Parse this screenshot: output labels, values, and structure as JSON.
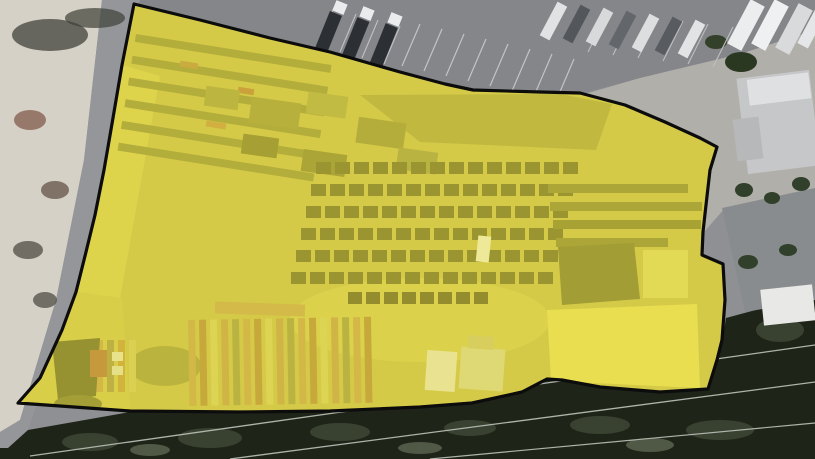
{
  "map": {
    "type": "satellite-imagery",
    "description": "Aerial satellite view of an industrial lumber/storage yard parcel highlighted with a yellow polygon outline",
    "overlay": {
      "name": "parcel-highlight",
      "fill": "#e8de3a",
      "fill_opacity": 0.44,
      "stroke": "#0c0c0c",
      "stroke_width": 3.2,
      "points": "134,4 200,20 270,38 330,52 400,72 445,84 473,90 540,92 580,93 625,105 665,122 700,138 717,147 710,170 706,205 703,232 702,255 723,264 725,300 722,340 717,360 708,389 660,392 600,387 562,380 547,379 522,392 472,403 420,407 330,411 240,412 130,411 60,406 18,403 40,378 62,330 76,292 86,252 95,215 104,170 113,118 122,65"
    },
    "features": [
      {
        "kind": "rect",
        "name": "asphalt-base",
        "x": 0,
        "y": 0,
        "w": 815,
        "h": 459,
        "fill": "#8e9093"
      },
      {
        "kind": "polygon",
        "name": "parking-lot",
        "points": "0,0 815,0 815,30 740,54 640,78 580,94 470,91 400,72 330,52 134,4",
        "fill": "#84868a"
      },
      {
        "kind": "polygon",
        "name": "concrete-apron",
        "points": "585,94 640,78 740,54 815,30 815,200 725,208 704,232 706,178 717,147 665,122 622,104",
        "fill": "#b1afaa"
      },
      {
        "kind": "polygon",
        "name": "debris-lot",
        "points": "0,0 102,0 84,160 56,300 20,420 0,432",
        "fill": "#d6d1c6"
      },
      {
        "kind": "polygon",
        "name": "road",
        "points": "102,0 140,0 122,65 104,170 86,252 62,330 28,430 8,448 0,448 0,432 20,420 56,300 84,160",
        "fill": "#95969a"
      },
      {
        "kind": "ellipse",
        "name": "debris-shadow",
        "cx": 50,
        "cy": 35,
        "rx": 38,
        "ry": 16,
        "fill": "#4b4b44",
        "opacity": 0.8
      },
      {
        "kind": "ellipse",
        "name": "debris-shadow",
        "cx": 95,
        "cy": 18,
        "rx": 30,
        "ry": 10,
        "fill": "#3f4038",
        "opacity": 0.7
      },
      {
        "kind": "ellipse",
        "name": "debris-pile",
        "cx": 30,
        "cy": 120,
        "rx": 16,
        "ry": 10,
        "fill": "#8c6a5a",
        "opacity": 0.85
      },
      {
        "kind": "ellipse",
        "name": "debris-pile",
        "cx": 55,
        "cy": 190,
        "rx": 14,
        "ry": 9,
        "fill": "#6b5a50",
        "opacity": 0.8
      },
      {
        "kind": "ellipse",
        "name": "debris-pile",
        "cx": 28,
        "cy": 250,
        "rx": 15,
        "ry": 9,
        "fill": "#57544c",
        "opacity": 0.8
      },
      {
        "kind": "ellipse",
        "name": "debris-pile",
        "cx": 45,
        "cy": 300,
        "rx": 12,
        "ry": 8,
        "fill": "#4e4c44",
        "opacity": 0.75
      },
      {
        "kind": "polygon",
        "name": "tree-canopy",
        "points": "0,448 8,448 28,430 130,412 240,413 330,412 420,408 472,403 522,392 547,379 562,380 600,387 660,392 708,389 717,360 724,330 726,318 815,294 815,459 0,459",
        "fill": "#1f2419"
      },
      {
        "kind": "ellipse",
        "name": "tree-blob",
        "cx": 90,
        "cy": 442,
        "rx": 28,
        "ry": 9,
        "fill": "#3c4634",
        "opacity": 0.9
      },
      {
        "kind": "ellipse",
        "name": "tree-blob",
        "cx": 210,
        "cy": 438,
        "rx": 32,
        "ry": 10,
        "fill": "#3c4634",
        "opacity": 0.9
      },
      {
        "kind": "ellipse",
        "name": "tree-blob",
        "cx": 340,
        "cy": 432,
        "rx": 30,
        "ry": 9,
        "fill": "#3c4634",
        "opacity": 0.9
      },
      {
        "kind": "ellipse",
        "name": "tree-blob",
        "cx": 470,
        "cy": 428,
        "rx": 26,
        "ry": 8,
        "fill": "#3c4634",
        "opacity": 0.9
      },
      {
        "kind": "ellipse",
        "name": "tree-blob",
        "cx": 600,
        "cy": 425,
        "rx": 30,
        "ry": 9,
        "fill": "#3c4634",
        "opacity": 0.9
      },
      {
        "kind": "ellipse",
        "name": "tree-blob",
        "cx": 720,
        "cy": 430,
        "rx": 34,
        "ry": 10,
        "fill": "#3c4634",
        "opacity": 0.9
      },
      {
        "kind": "ellipse",
        "name": "tree-blob",
        "cx": 780,
        "cy": 330,
        "rx": 24,
        "ry": 12,
        "fill": "#3c4634",
        "opacity": 0.9
      },
      {
        "kind": "ellipse",
        "name": "tree-blob",
        "cx": 150,
        "cy": 450,
        "rx": 20,
        "ry": 6,
        "fill": "#5d6650",
        "opacity": 0.8
      },
      {
        "kind": "ellipse",
        "name": "tree-blob",
        "cx": 420,
        "cy": 448,
        "rx": 22,
        "ry": 6,
        "fill": "#5d6650",
        "opacity": 0.8
      },
      {
        "kind": "ellipse",
        "name": "tree-blob",
        "cx": 650,
        "cy": 445,
        "rx": 24,
        "ry": 7,
        "fill": "#5d6650",
        "opacity": 0.8
      },
      {
        "kind": "line",
        "name": "power-line",
        "x1": 30,
        "y1": 456,
        "x2": 815,
        "y2": 345,
        "stroke": "#aeb4aa",
        "sw": 1.3
      },
      {
        "kind": "line",
        "name": "power-line",
        "x1": 230,
        "y1": 459,
        "x2": 815,
        "y2": 382,
        "stroke": "#aeb4aa",
        "sw": 1.3
      },
      {
        "kind": "line",
        "name": "power-line",
        "x1": 430,
        "y1": 459,
        "x2": 815,
        "y2": 423,
        "stroke": "#aeb4aa",
        "sw": 1.2
      },
      {
        "kind": "rect",
        "name": "building-roof-light",
        "x": 742,
        "y": 74,
        "w": 73,
        "h": 96,
        "fill": "#c6c7c9",
        "rot": -7
      },
      {
        "kind": "rect",
        "name": "building-roof-white",
        "x": 748,
        "y": 76,
        "w": 62,
        "h": 26,
        "fill": "#dfe0e2",
        "rot": -7
      },
      {
        "kind": "rect",
        "name": "building-annex",
        "x": 735,
        "y": 118,
        "w": 26,
        "h": 42,
        "fill": "#b7b8ba",
        "rot": -7
      },
      {
        "kind": "polygon",
        "name": "building-dark-block",
        "points": "722,208 815,188 815,300 745,312",
        "fill": "#898c8e"
      },
      {
        "kind": "ellipse",
        "name": "shrub",
        "cx": 744,
        "cy": 190,
        "rx": 9,
        "ry": 7,
        "fill": "#31402a"
      },
      {
        "kind": "ellipse",
        "name": "shrub",
        "cx": 772,
        "cy": 198,
        "rx": 8,
        "ry": 6,
        "fill": "#31402a"
      },
      {
        "kind": "ellipse",
        "name": "shrub",
        "cx": 801,
        "cy": 184,
        "rx": 9,
        "ry": 7,
        "fill": "#31402a"
      },
      {
        "kind": "ellipse",
        "name": "shrub",
        "cx": 748,
        "cy": 262,
        "rx": 10,
        "ry": 7,
        "fill": "#31402a"
      },
      {
        "kind": "ellipse",
        "name": "shrub",
        "cx": 788,
        "cy": 250,
        "rx": 9,
        "ry": 6,
        "fill": "#31402a"
      },
      {
        "kind": "rect",
        "name": "building-white-small",
        "x": 762,
        "y": 287,
        "w": 52,
        "h": 36,
        "fill": "#e8e8e6",
        "rot": -6
      },
      {
        "kind": "ellipse",
        "name": "palm-tree",
        "cx": 741,
        "cy": 62,
        "rx": 16,
        "ry": 10,
        "fill": "#2b3821"
      },
      {
        "kind": "ellipse",
        "name": "palm-tree",
        "cx": 716,
        "cy": 42,
        "rx": 11,
        "ry": 7,
        "fill": "#33402a"
      },
      {
        "kind": "lineset",
        "name": "parking-stripes",
        "x": 402,
        "y": 66,
        "dx": 18,
        "dy": -42,
        "n": 8,
        "sx": 22,
        "sy": 5,
        "stroke": "#c2c4c6",
        "sw": 1.2
      },
      {
        "kind": "lineset",
        "name": "parking-stripes",
        "x": 318,
        "y": 46,
        "dx": 16,
        "dy": -38,
        "n": 4,
        "sx": 22,
        "sy": 6,
        "stroke": "#bfc1c3",
        "sw": 1.1
      },
      {
        "kind": "lineset",
        "name": "parking-stripes",
        "x": 588,
        "y": 52,
        "dx": 20,
        "dy": -40,
        "n": 6,
        "sx": 25,
        "sy": 3,
        "stroke": "#bcbec0",
        "sw": 1.1
      },
      {
        "kind": "rect",
        "name": "semi-truck-body",
        "x": 322,
        "y": 12,
        "w": 13,
        "h": 40,
        "fill": "#2c3035",
        "rot": 22
      },
      {
        "kind": "rect",
        "name": "semi-truck-body",
        "x": 349,
        "y": 18,
        "w": 13,
        "h": 42,
        "fill": "#2c3035",
        "rot": 22
      },
      {
        "kind": "rect",
        "name": "semi-truck-body",
        "x": 377,
        "y": 24,
        "w": 13,
        "h": 44,
        "fill": "#2c3035",
        "rot": 22
      },
      {
        "kind": "rect",
        "name": "semi-truck-cab",
        "x": 334,
        "y": 2,
        "w": 12,
        "h": 11,
        "fill": "#e9ebed",
        "rot": 22
      },
      {
        "kind": "rect",
        "name": "semi-truck-cab",
        "x": 361,
        "y": 8,
        "w": 12,
        "h": 11,
        "fill": "#e9ebed",
        "rot": 22
      },
      {
        "kind": "rect",
        "name": "semi-truck-cab",
        "x": 389,
        "y": 14,
        "w": 12,
        "h": 11,
        "fill": "#e9ebed",
        "rot": 22
      },
      {
        "kind": "rect",
        "name": "parked-trailer",
        "x": 548,
        "y": 2,
        "w": 11,
        "h": 38,
        "fill": "#e0e2e4",
        "rot": 28
      },
      {
        "kind": "rect",
        "name": "parked-trailer",
        "x": 571,
        "y": 5,
        "w": 11,
        "h": 38,
        "fill": "#53575b",
        "rot": 28
      },
      {
        "kind": "rect",
        "name": "parked-trailer",
        "x": 594,
        "y": 8,
        "w": 11,
        "h": 38,
        "fill": "#d7d9db",
        "rot": 28
      },
      {
        "kind": "rect",
        "name": "parked-trailer",
        "x": 617,
        "y": 11,
        "w": 11,
        "h": 38,
        "fill": "#63676b",
        "rot": 28
      },
      {
        "kind": "rect",
        "name": "parked-trailer",
        "x": 640,
        "y": 14,
        "w": 11,
        "h": 38,
        "fill": "#dcdee0",
        "rot": 28
      },
      {
        "kind": "rect",
        "name": "parked-trailer",
        "x": 663,
        "y": 17,
        "w": 11,
        "h": 38,
        "fill": "#585c60",
        "rot": 28
      },
      {
        "kind": "rect",
        "name": "parked-trailer",
        "x": 686,
        "y": 20,
        "w": 11,
        "h": 38,
        "fill": "#e2e3e5",
        "rot": 28
      },
      {
        "kind": "rect",
        "name": "parked-trailer",
        "x": 738,
        "y": 0,
        "w": 16,
        "h": 50,
        "fill": "#ebedef",
        "rot": 28
      },
      {
        "kind": "rect",
        "name": "parked-trailer",
        "x": 762,
        "y": 0,
        "w": 16,
        "h": 50,
        "fill": "#eff0f2",
        "rot": 28
      },
      {
        "kind": "rect",
        "name": "parked-trailer",
        "x": 786,
        "y": 4,
        "w": 16,
        "h": 50,
        "fill": "#d8dadc",
        "rot": 28
      },
      {
        "kind": "rect",
        "name": "parked-trailer",
        "x": 806,
        "y": 8,
        "w": 12,
        "h": 40,
        "fill": "#e5e6e8",
        "rot": 28
      },
      {
        "kind": "rect",
        "name": "yard-ground",
        "x": 0,
        "y": 0,
        "w": 815,
        "h": 459,
        "fill": "#c6ba52",
        "clip": true
      },
      {
        "kind": "polygon",
        "name": "yard-bright-left",
        "points": "122,65 160,76 120,298 76,292",
        "fill": "#d6cb5c",
        "clip": true
      },
      {
        "kind": "polygon",
        "name": "yard-bright-sw",
        "points": "76,292 122,298 130,410 18,403 40,378 62,330",
        "fill": "#ccc052",
        "clip": true
      },
      {
        "kind": "ellipse",
        "name": "yard-open-ground",
        "cx": 420,
        "cy": 320,
        "rx": 130,
        "ry": 42,
        "fill": "#d2c75a",
        "clip": true
      },
      {
        "kind": "polygon",
        "name": "yard-bright-se",
        "points": "547,310 697,304 700,388 551,381",
        "fill": "#e8de62",
        "clip": true
      },
      {
        "kind": "polygon",
        "name": "yard-dense-storage",
        "points": "360,95 560,94 612,104 596,150 420,142",
        "fill": "#9d9745",
        "opacity": 0.9,
        "clip": true
      },
      {
        "kind": "stripes",
        "name": "storage-racks-nw",
        "x": 136,
        "y": 34,
        "w": 198,
        "h": 8,
        "n": 6,
        "step": 22,
        "dir": "h",
        "colors": [
          "#8a873d"
        ],
        "rot": 9,
        "clip": true
      },
      {
        "kind": "rect",
        "name": "rack-lumber-accent",
        "x": 180,
        "y": 62,
        "w": 18,
        "h": 6,
        "fill": "#b08246",
        "rot": 9,
        "clip": true
      },
      {
        "kind": "rect",
        "name": "rack-lumber-accent",
        "x": 238,
        "y": 88,
        "w": 16,
        "h": 6,
        "fill": "#b5713d",
        "rot": 9,
        "clip": true
      },
      {
        "kind": "rect",
        "name": "rack-lumber-accent",
        "x": 206,
        "y": 122,
        "w": 20,
        "h": 6,
        "fill": "#bf8a47",
        "rot": 9,
        "clip": true
      },
      {
        "kind": "rect",
        "name": "yard-structure",
        "x": 205,
        "y": 88,
        "w": 34,
        "h": 20,
        "fill": "#9a9545",
        "rot": 8,
        "clip": true
      },
      {
        "kind": "rect",
        "name": "yard-structure",
        "x": 250,
        "y": 100,
        "w": 50,
        "h": 26,
        "fill": "#908b40",
        "rot": 8,
        "clip": true
      },
      {
        "kind": "rect",
        "name": "yard-structure",
        "x": 307,
        "y": 94,
        "w": 40,
        "h": 22,
        "fill": "#a39d4b",
        "rot": 8,
        "clip": true
      },
      {
        "kind": "rect",
        "name": "yard-structure",
        "x": 357,
        "y": 120,
        "w": 48,
        "h": 26,
        "fill": "#8b863d",
        "rot": 8,
        "clip": true
      },
      {
        "kind": "rect",
        "name": "yard-structure",
        "x": 242,
        "y": 136,
        "w": 36,
        "h": 20,
        "fill": "#706d31",
        "rot": 8,
        "clip": true
      },
      {
        "kind": "rect",
        "name": "yard-structure",
        "x": 302,
        "y": 152,
        "w": 44,
        "h": 22,
        "fill": "#7b7736",
        "rot": 8,
        "clip": true
      },
      {
        "kind": "rect",
        "name": "yard-structure",
        "x": 397,
        "y": 150,
        "w": 40,
        "h": 22,
        "fill": "#959149",
        "rot": 8,
        "clip": true
      },
      {
        "kind": "grid",
        "name": "nursery-stock-grid",
        "x": 316,
        "y": 162,
        "rows": 6,
        "cols": 14,
        "cw": 15,
        "ch": 12,
        "gx": 19,
        "gy": 22,
        "rxoff": -5,
        "fill": "#5e5c29",
        "clip": true
      },
      {
        "kind": "grid",
        "name": "nursery-stock-row",
        "x": 348,
        "y": 292,
        "rows": 1,
        "cols": 8,
        "cw": 14,
        "ch": 12,
        "gx": 18,
        "gy": 0,
        "rxoff": 0,
        "fill": "#504e25",
        "clip": true
      },
      {
        "kind": "rect",
        "name": "storage-rack-east",
        "x": 548,
        "y": 184,
        "w": 140,
        "h": 9,
        "fill": "#7c7936",
        "clip": true
      },
      {
        "kind": "rect",
        "name": "storage-rack-east",
        "x": 550,
        "y": 202,
        "w": 152,
        "h": 9,
        "fill": "#7c7936",
        "clip": true
      },
      {
        "kind": "rect",
        "name": "storage-rack-east",
        "x": 553,
        "y": 220,
        "w": 148,
        "h": 9,
        "fill": "#767333",
        "clip": true
      },
      {
        "kind": "rect",
        "name": "storage-rack-east",
        "x": 556,
        "y": 238,
        "w": 112,
        "h": 9,
        "fill": "#7c7936",
        "clip": true
      },
      {
        "kind": "polygon",
        "name": "warehouse-dark-roof",
        "points": "558,247 634,243 640,299 562,305",
        "fill": "#6b6930",
        "clip": true
      },
      {
        "kind": "rect",
        "name": "yard-bright-patch",
        "x": 643,
        "y": 250,
        "w": 45,
        "h": 48,
        "fill": "#ddd46c",
        "clip": true
      },
      {
        "kind": "rect",
        "name": "white-van",
        "x": 477,
        "y": 236,
        "w": 13,
        "h": 26,
        "fill": "#f3f1e3",
        "rot": 6,
        "clip": true
      },
      {
        "kind": "ellipse",
        "name": "yard-shadow",
        "cx": 165,
        "cy": 366,
        "rx": 36,
        "ry": 20,
        "fill": "#8d8840",
        "opacity": 0.85,
        "clip": true
      },
      {
        "kind": "stripes",
        "name": "lumber-stacks",
        "x": 188,
        "y": 320,
        "w": 7,
        "h": 86,
        "n": 17,
        "step": 11,
        "dir": "v",
        "colors": [
          "#c59a52",
          "#ae7e3e",
          "#d6cc6a",
          "#bd9350",
          "#97914a"
        ],
        "rot": -1,
        "clip": true
      },
      {
        "kind": "stripes",
        "name": "lumber-stacks-small",
        "x": 96,
        "y": 340,
        "w": 7,
        "h": 52,
        "n": 4,
        "step": 11,
        "dir": "v",
        "colors": [
          "#c59a52",
          "#9d8c4a",
          "#c0903e",
          "#d0c565"
        ],
        "clip": true
      },
      {
        "kind": "rect",
        "name": "lumber-rack-bar",
        "x": 215,
        "y": 303,
        "w": 90,
        "h": 12,
        "fill": "#c49e56",
        "rot": 2,
        "clip": true
      },
      {
        "kind": "polygon",
        "name": "shed-dark",
        "points": "52,342 100,338 96,396 58,400",
        "fill": "#56542b",
        "clip": true
      },
      {
        "kind": "rect",
        "name": "container-orange",
        "x": 90,
        "y": 350,
        "w": 17,
        "h": 27,
        "fill": "#ad6240",
        "clip": true
      },
      {
        "kind": "rect",
        "name": "shed-white",
        "x": 112,
        "y": 352,
        "w": 11,
        "h": 9,
        "fill": "#e8e4cc",
        "clip": true
      },
      {
        "kind": "rect",
        "name": "shed-white",
        "x": 112,
        "y": 366,
        "w": 11,
        "h": 9,
        "fill": "#e3dfc6",
        "clip": true
      },
      {
        "kind": "ellipse",
        "name": "yard-shadow",
        "cx": 78,
        "cy": 404,
        "rx": 24,
        "ry": 9,
        "fill": "#6f6c34",
        "clip": true
      },
      {
        "kind": "rect",
        "name": "yard-building-white",
        "x": 426,
        "y": 351,
        "w": 30,
        "h": 40,
        "fill": "#eae7d6",
        "rot": 4,
        "clip": true
      },
      {
        "kind": "rect",
        "name": "yard-building-tan",
        "x": 460,
        "y": 348,
        "w": 44,
        "h": 42,
        "fill": "#d7d2a4",
        "rot": 4,
        "clip": true
      },
      {
        "kind": "rect",
        "name": "yard-building-roof",
        "x": 468,
        "y": 336,
        "w": 26,
        "h": 13,
        "fill": "#c9c17a",
        "rot": 4,
        "clip": true
      }
    ]
  }
}
